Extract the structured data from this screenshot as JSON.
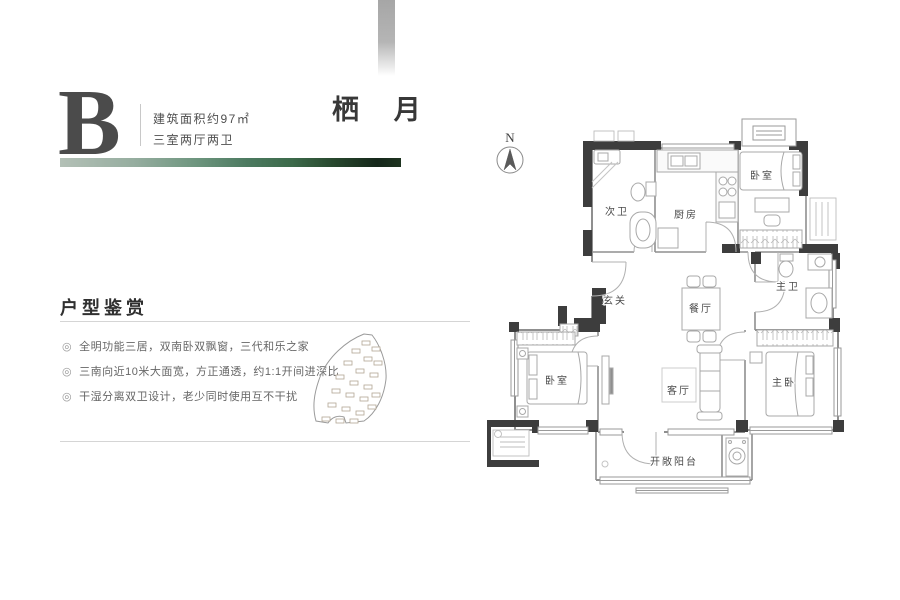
{
  "header": {
    "block_letter": "B",
    "area_line": "建筑面积约97㎡",
    "layout_line": "三室两厅两卫",
    "plan_title": "栖 月"
  },
  "appreciation": {
    "heading": "户型鉴赏",
    "marker": "◎",
    "bullets": [
      "全明功能三居，双南卧双飘窗，三代和乐之家",
      "三南向近10米大面宽，方正通透，约1:1开间进深比",
      "干湿分离双卫设计，老少同时使用互不干扰"
    ]
  },
  "floorplan": {
    "compass": "N",
    "rooms": {
      "second_bath": "次卫",
      "kitchen": "厨房",
      "bedroom_north": "卧室",
      "foyer": "玄关",
      "dining": "餐厅",
      "master_bath": "主卫",
      "bedroom_south": "卧室",
      "living": "客厅",
      "master_bedroom": "主卧",
      "balcony": "开敞阳台"
    }
  },
  "colors": {
    "accent_green": "#4c7a60",
    "accent_dark_green": "#15271a",
    "wall_dark": "#3d3d3d",
    "wall_gray": "#8f8f8f",
    "text_primary": "#3c3c3c"
  }
}
